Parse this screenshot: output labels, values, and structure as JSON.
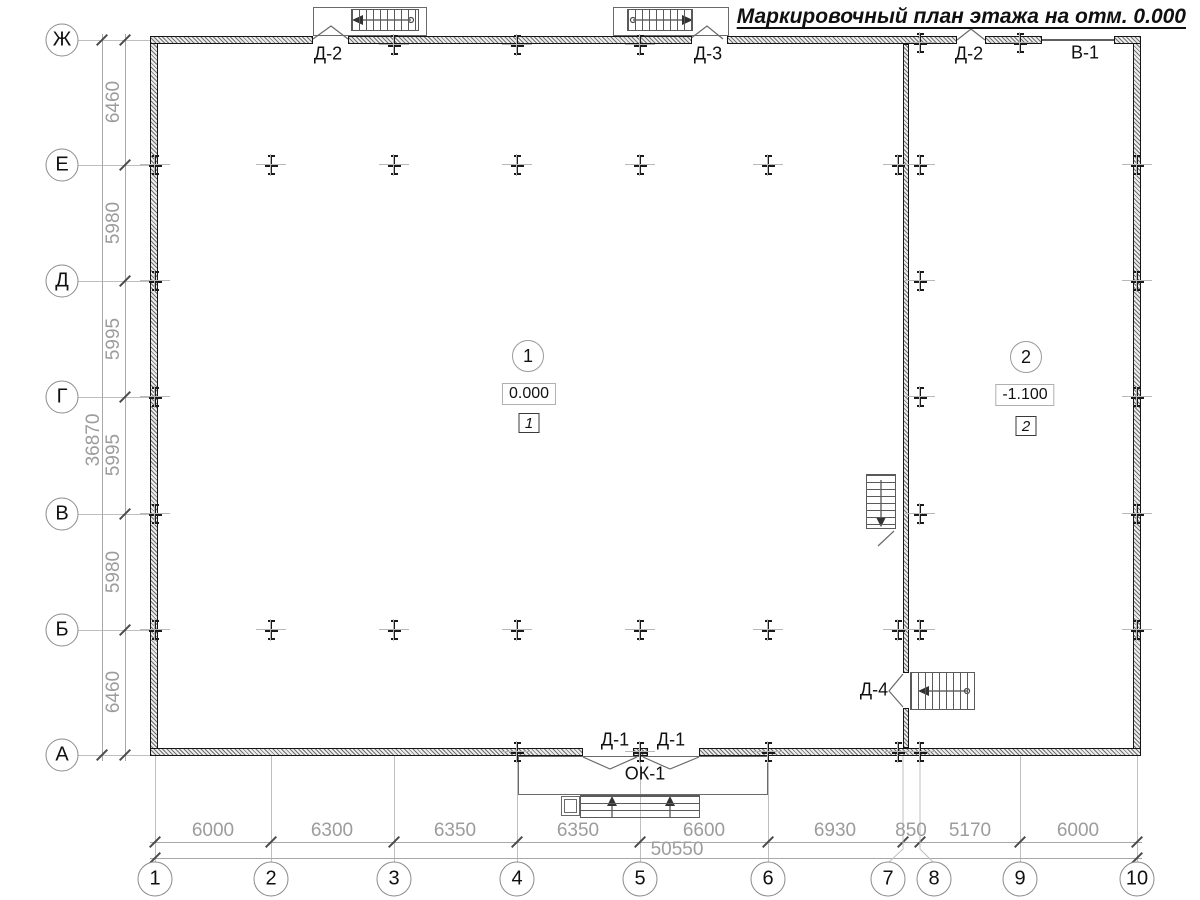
{
  "title": "Маркировочный план этажа на отм. 0.000",
  "axes": {
    "rows": [
      "Ж",
      "Е",
      "Д",
      "Г",
      "В",
      "Б",
      "А"
    ],
    "cols": [
      "1",
      "2",
      "3",
      "4",
      "5",
      "6",
      "7",
      "8",
      "9",
      "10"
    ]
  },
  "dims": {
    "left": {
      "segments": [
        "6460",
        "5980",
        "5995",
        "5995",
        "5980",
        "6460"
      ],
      "total": "36870"
    },
    "bottom": {
      "segments": [
        "6000",
        "6300",
        "6350",
        "6350",
        "6600",
        "6930",
        "850",
        "5170",
        "6000"
      ],
      "total": "50550"
    }
  },
  "rooms": [
    {
      "number": "1",
      "elevation": "0.000",
      "zone": "1"
    },
    {
      "number": "2",
      "elevation": "-1.100",
      "zone": "2"
    }
  ],
  "doors": {
    "top_left": "Д-2",
    "top_mid": "Д-3",
    "top_right": "Д-2",
    "gate_top": "В-1",
    "bottom_left": "Д-1",
    "bottom_right": "Д-1",
    "porch": "ОК-1",
    "divider": "Д-4"
  },
  "colors": {
    "line_dark": "#151515",
    "line_gray": "#bfbfbf",
    "dim_text": "#9c9c9c"
  }
}
